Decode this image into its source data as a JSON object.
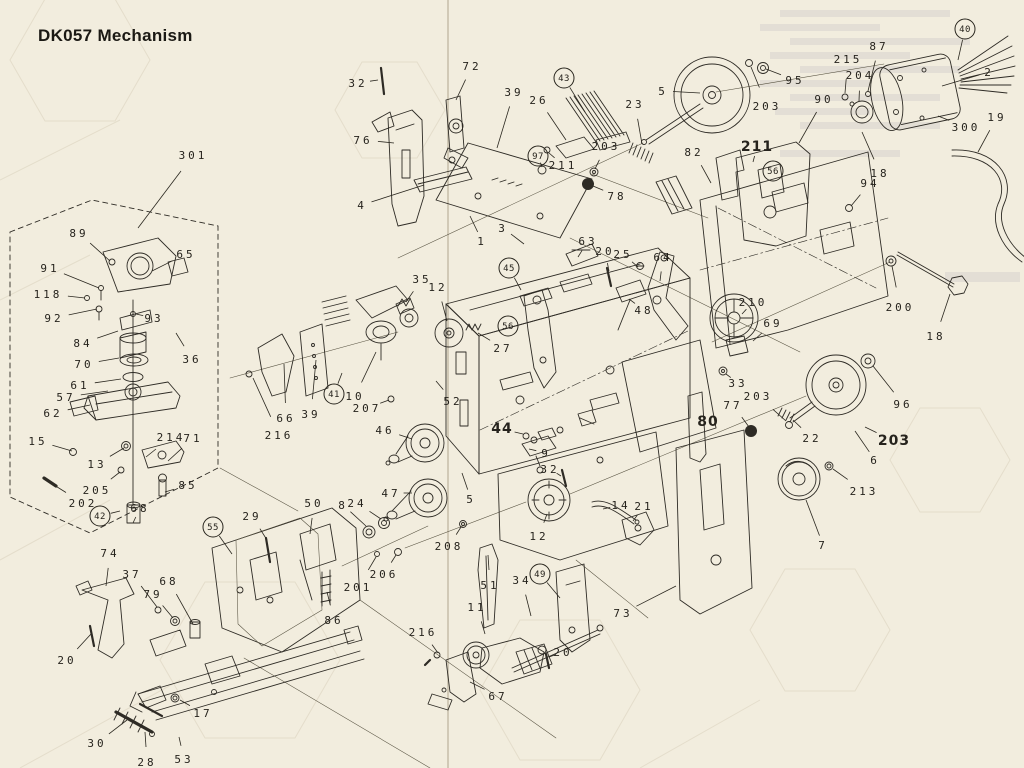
{
  "page": {
    "title": "DK057 Mechanism",
    "paper_color": "#f2edde",
    "ink_color": "#2e2b25"
  },
  "diagram": {
    "description": "Exploded parts view of cassette deck mechanism DK057",
    "labels": [
      {
        "t": "301",
        "x": 193,
        "y": 155,
        "lx": 138,
        "ly": 228
      },
      {
        "t": "32",
        "x": 358,
        "y": 83,
        "lx": 378,
        "ly": 80
      },
      {
        "t": "72",
        "x": 472,
        "y": 66,
        "lx": 456,
        "ly": 100
      },
      {
        "t": "76",
        "x": 363,
        "y": 140,
        "lx": 394,
        "ly": 143
      },
      {
        "t": "4",
        "x": 362,
        "y": 205,
        "lx": 424,
        "ly": 185
      },
      {
        "t": "39",
        "x": 514,
        "y": 92,
        "lx": 497,
        "ly": 148
      },
      {
        "t": "26",
        "x": 539,
        "y": 100,
        "lx": 566,
        "ly": 140
      },
      {
        "t": "43",
        "x": 564,
        "y": 78,
        "c": true,
        "lx": 585,
        "ly": 112
      },
      {
        "t": "97",
        "x": 538,
        "y": 156,
        "c": true,
        "lx": 542,
        "ly": 167
      },
      {
        "t": "211",
        "x": 563,
        "y": 165,
        "lx": 549,
        "ly": 153
      },
      {
        "t": "203",
        "x": 606,
        "y": 146,
        "lx": 595,
        "ly": 169
      },
      {
        "t": "23",
        "x": 635,
        "y": 104,
        "lx": 642,
        "ly": 144
      },
      {
        "t": "78",
        "x": 617,
        "y": 196,
        "lx": 593,
        "ly": 186
      },
      {
        "t": "1",
        "x": 482,
        "y": 241,
        "lx": 470,
        "ly": 216
      },
      {
        "t": "3",
        "x": 503,
        "y": 228,
        "lx": 524,
        "ly": 244
      },
      {
        "t": "63",
        "x": 588,
        "y": 241,
        "lx": 578,
        "ly": 257
      },
      {
        "t": "20",
        "x": 605,
        "y": 251,
        "lx": 609,
        "ly": 271
      },
      {
        "t": "25",
        "x": 623,
        "y": 254,
        "lx": 638,
        "ly": 267
      },
      {
        "t": "64",
        "x": 663,
        "y": 257,
        "lx": 660,
        "ly": 281
      },
      {
        "t": "48",
        "x": 644,
        "y": 310,
        "lx": 629,
        "ly": 299
      },
      {
        "t": "5",
        "x": 663,
        "y": 91,
        "lx": 700,
        "ly": 93
      },
      {
        "t": "95",
        "x": 795,
        "y": 80,
        "lx": 766,
        "ly": 69
      },
      {
        "t": "203",
        "x": 767,
        "y": 106,
        "lx": 751,
        "ly": 67
      },
      {
        "t": "90",
        "x": 824,
        "y": 99,
        "lx": 799,
        "ly": 143
      },
      {
        "t": "215",
        "x": 848,
        "y": 59,
        "lx": 845,
        "ly": 93
      },
      {
        "t": "87",
        "x": 879,
        "y": 46,
        "lx": 868,
        "ly": 91
      },
      {
        "t": "204",
        "x": 860,
        "y": 75,
        "lx": 859,
        "ly": 101
      },
      {
        "t": "2",
        "x": 989,
        "y": 72,
        "lx": 942,
        "ly": 86
      },
      {
        "t": "300",
        "x": 966,
        "y": 127,
        "lx": 938,
        "ly": 116
      },
      {
        "t": "19",
        "x": 997,
        "y": 117,
        "lx": 978,
        "ly": 152
      },
      {
        "t": "40",
        "x": 965,
        "y": 29,
        "c": true,
        "lx": 958,
        "ly": 60
      },
      {
        "t": "82",
        "x": 694,
        "y": 152,
        "lx": 711,
        "ly": 183
      },
      {
        "t": "211",
        "x": 757,
        "y": 147,
        "b": true,
        "lx": 753,
        "ly": 162
      },
      {
        "t": "56",
        "x": 773,
        "y": 171,
        "c": true
      },
      {
        "t": "18",
        "x": 880,
        "y": 173,
        "lx": 862,
        "ly": 132
      },
      {
        "t": "94",
        "x": 870,
        "y": 183,
        "lx": 851,
        "ly": 206
      },
      {
        "t": "89",
        "x": 79,
        "y": 233,
        "lx": 110,
        "ly": 261
      },
      {
        "t": "65",
        "x": 186,
        "y": 254,
        "lx": 152,
        "ly": 271
      },
      {
        "t": "91",
        "x": 50,
        "y": 268,
        "lx": 99,
        "ly": 288
      },
      {
        "t": "118",
        "x": 48,
        "y": 294,
        "lx": 85,
        "ly": 298
      },
      {
        "t": "92",
        "x": 54,
        "y": 318,
        "lx": 97,
        "ly": 309
      },
      {
        "t": "93",
        "x": 154,
        "y": 318,
        "lx": 136,
        "ly": 314
      },
      {
        "t": "84",
        "x": 83,
        "y": 343,
        "lx": 118,
        "ly": 331
      },
      {
        "t": "70",
        "x": 84,
        "y": 364,
        "lx": 119,
        "ly": 358
      },
      {
        "t": "61",
        "x": 80,
        "y": 385,
        "lx": 121,
        "ly": 379
      },
      {
        "t": "36",
        "x": 192,
        "y": 359,
        "lx": 176,
        "ly": 333
      },
      {
        "t": "57",
        "x": 66,
        "y": 397,
        "lx": 108,
        "ly": 391
      },
      {
        "t": "62",
        "x": 53,
        "y": 413,
        "lx": 90,
        "ly": 405
      },
      {
        "t": "15",
        "x": 38,
        "y": 441,
        "lx": 72,
        "ly": 451
      },
      {
        "t": "13",
        "x": 97,
        "y": 464,
        "lx": 124,
        "ly": 448
      },
      {
        "t": "214",
        "x": 171,
        "y": 437,
        "lx": 146,
        "ly": 457
      },
      {
        "t": "71",
        "x": 193,
        "y": 438,
        "lx": 168,
        "ly": 461
      },
      {
        "t": "205",
        "x": 97,
        "y": 490,
        "lx": 120,
        "ly": 472
      },
      {
        "t": "202",
        "x": 83,
        "y": 503,
        "lx": 54,
        "ly": 485
      },
      {
        "t": "42",
        "x": 100,
        "y": 516,
        "c": true,
        "lx": 120,
        "ly": 511
      },
      {
        "t": "68",
        "x": 140,
        "y": 508,
        "lx": 133,
        "ly": 523
      },
      {
        "t": "85",
        "x": 188,
        "y": 485,
        "lx": 165,
        "ly": 492
      },
      {
        "t": "35",
        "x": 422,
        "y": 279,
        "lx": 406,
        "ly": 302
      },
      {
        "t": "12",
        "x": 438,
        "y": 287,
        "lx": 447,
        "ly": 321
      },
      {
        "t": "45",
        "x": 509,
        "y": 268,
        "c": true,
        "lx": 521,
        "ly": 290
      },
      {
        "t": "56",
        "x": 508,
        "y": 326,
        "c": true
      },
      {
        "t": "27",
        "x": 503,
        "y": 348,
        "lx": 478,
        "ly": 333
      },
      {
        "t": "41",
        "x": 334,
        "y": 394,
        "c": true,
        "lx": 342,
        "ly": 373
      },
      {
        "t": "10",
        "x": 355,
        "y": 396,
        "lx": 376,
        "ly": 352
      },
      {
        "t": "207",
        "x": 367,
        "y": 408,
        "lx": 389,
        "ly": 400
      },
      {
        "t": "52",
        "x": 453,
        "y": 401,
        "lx": 436,
        "ly": 381
      },
      {
        "t": "66",
        "x": 286,
        "y": 418,
        "lx": 284,
        "ly": 364
      },
      {
        "t": "39",
        "x": 311,
        "y": 414,
        "lx": 316,
        "ly": 360
      },
      {
        "t": "216",
        "x": 279,
        "y": 435,
        "lx": 253,
        "ly": 378
      },
      {
        "t": "46",
        "x": 385,
        "y": 430,
        "lx": 412,
        "ly": 439
      },
      {
        "t": "44",
        "x": 502,
        "y": 429,
        "b": true,
        "lx": 523,
        "ly": 434
      },
      {
        "t": "9",
        "x": 546,
        "y": 453,
        "lx": 529,
        "ly": 449
      },
      {
        "t": "32",
        "x": 550,
        "y": 469,
        "lx": 561,
        "ly": 476
      },
      {
        "t": "5",
        "x": 471,
        "y": 499,
        "lx": 462,
        "ly": 473
      },
      {
        "t": "47",
        "x": 391,
        "y": 493,
        "lx": 412,
        "ly": 493
      },
      {
        "t": "8",
        "x": 343,
        "y": 505,
        "lx": 366,
        "ly": 526
      },
      {
        "t": "24",
        "x": 357,
        "y": 503,
        "lx": 381,
        "ly": 519
      },
      {
        "t": "208",
        "x": 449,
        "y": 546,
        "lx": 461,
        "ly": 527
      },
      {
        "t": "12",
        "x": 539,
        "y": 536,
        "lx": 547,
        "ly": 514
      },
      {
        "t": "14",
        "x": 621,
        "y": 505,
        "lx": 603,
        "ly": 509
      },
      {
        "t": "21",
        "x": 644,
        "y": 506,
        "lx": 633,
        "ly": 521
      },
      {
        "t": "206",
        "x": 384,
        "y": 574,
        "lx": 396,
        "ly": 555
      },
      {
        "t": "201",
        "x": 358,
        "y": 587,
        "lx": 376,
        "ly": 557
      },
      {
        "t": "51",
        "x": 490,
        "y": 585,
        "lx": 488,
        "ly": 555
      },
      {
        "t": "34",
        "x": 522,
        "y": 580,
        "lx": 531,
        "ly": 616
      },
      {
        "t": "49",
        "x": 540,
        "y": 574,
        "c": true,
        "lx": 560,
        "ly": 598
      },
      {
        "t": "11",
        "x": 477,
        "y": 607,
        "lx": 485,
        "ly": 634
      },
      {
        "t": "216",
        "x": 423,
        "y": 632,
        "lx": 438,
        "ly": 653
      },
      {
        "t": "20",
        "x": 563,
        "y": 652,
        "lx": 549,
        "ly": 657
      },
      {
        "t": "67",
        "x": 498,
        "y": 696,
        "lx": 470,
        "ly": 682
      },
      {
        "t": "73",
        "x": 623,
        "y": 613,
        "lx": 676,
        "ly": 586
      },
      {
        "t": "210",
        "x": 753,
        "y": 302,
        "lx": 742,
        "ly": 314
      },
      {
        "t": "69",
        "x": 773,
        "y": 323,
        "lx": 753,
        "ly": 341
      },
      {
        "t": "33",
        "x": 738,
        "y": 383,
        "lx": 726,
        "ly": 374
      },
      {
        "t": "203",
        "x": 758,
        "y": 396,
        "lx": 786,
        "ly": 421
      },
      {
        "t": "77",
        "x": 733,
        "y": 405,
        "lx": 749,
        "ly": 427
      },
      {
        "t": "80",
        "x": 708,
        "y": 422,
        "b": true
      },
      {
        "t": "200",
        "x": 900,
        "y": 307,
        "lx": 892,
        "ly": 266
      },
      {
        "t": "18",
        "x": 936,
        "y": 336,
        "lx": 950,
        "ly": 294
      },
      {
        "t": "96",
        "x": 903,
        "y": 404,
        "lx": 873,
        "ly": 366
      },
      {
        "t": "203",
        "x": 894,
        "y": 441,
        "b": true,
        "lx": 865,
        "ly": 427
      },
      {
        "t": "6",
        "x": 875,
        "y": 460,
        "lx": 855,
        "ly": 431
      },
      {
        "t": "22",
        "x": 812,
        "y": 438,
        "lx": 793,
        "ly": 420
      },
      {
        "t": "213",
        "x": 864,
        "y": 491,
        "lx": 833,
        "ly": 469
      },
      {
        "t": "7",
        "x": 823,
        "y": 545,
        "lx": 806,
        "ly": 500
      },
      {
        "t": "74",
        "x": 110,
        "y": 553,
        "lx": 106,
        "ly": 586
      },
      {
        "t": "37",
        "x": 132,
        "y": 574,
        "lx": 157,
        "ly": 607
      },
      {
        "t": "79",
        "x": 153,
        "y": 594,
        "lx": 173,
        "ly": 618
      },
      {
        "t": "68",
        "x": 169,
        "y": 581,
        "lx": 193,
        "ly": 624
      },
      {
        "t": "55",
        "x": 213,
        "y": 527,
        "c": true,
        "lx": 232,
        "ly": 554
      },
      {
        "t": "29",
        "x": 252,
        "y": 516,
        "lx": 267,
        "ly": 540
      },
      {
        "t": "50",
        "x": 314,
        "y": 503,
        "lx": 310,
        "ly": 534
      },
      {
        "t": "86",
        "x": 334,
        "y": 620,
        "lx": 327,
        "ly": 592
      },
      {
        "t": "20",
        "x": 67,
        "y": 660,
        "lx": 91,
        "ly": 634
      },
      {
        "t": "17",
        "x": 203,
        "y": 713,
        "lx": 180,
        "ly": 700
      },
      {
        "t": "30",
        "x": 97,
        "y": 743,
        "lx": 127,
        "ly": 720
      },
      {
        "t": "28",
        "x": 147,
        "y": 762,
        "lx": 145,
        "ly": 732
      },
      {
        "t": "53",
        "x": 184,
        "y": 759,
        "lx": 179,
        "ly": 737
      }
    ]
  }
}
